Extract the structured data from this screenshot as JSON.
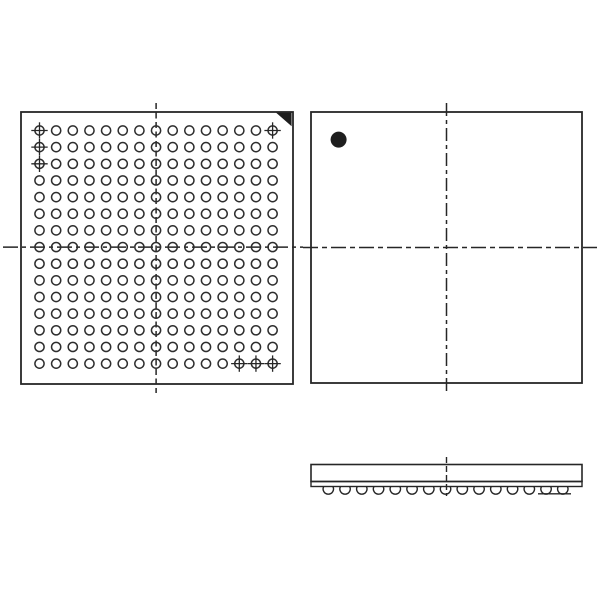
{
  "canvas": {
    "width": 600,
    "height": 600,
    "background": "#ffffff"
  },
  "colors": {
    "line": "#262626",
    "marker_fill": "#1e1e1e",
    "ball_stroke": "#2e2e2e"
  },
  "figure": {
    "kind": "ic-package-outline-drawing",
    "views": [
      "bottom-view-ball-grid",
      "top-view",
      "side-view"
    ]
  },
  "bottom_view": {
    "outline": {
      "x": 21,
      "y": 112,
      "width": 272,
      "height": 272,
      "stroke_width": 1.8
    },
    "ball_grid": {
      "rows": 15,
      "cols": 15,
      "total_balls": 225,
      "x0": 39.5,
      "y0": 130.5,
      "pitch": 16.65,
      "ball_radius": 4.6,
      "ball_stroke_width": 1.5
    },
    "marked_balls": [
      [
        1,
        1
      ],
      [
        2,
        1
      ],
      [
        3,
        1
      ],
      [
        1,
        15
      ],
      [
        15,
        13
      ],
      [
        15,
        14
      ],
      [
        15,
        15
      ]
    ],
    "marked_ball_arm_halflength": 8.2,
    "pin1_triangle_points": "276,112.6 291.6,112.6 291.6,126.2",
    "v_centerline": {
      "x": 156.1,
      "y1": 103,
      "y2": 393,
      "dash": "6 3.5"
    },
    "h_centerline": {
      "y": 247.1,
      "x1": 3,
      "x2": 303,
      "dash": "15 4 4 4"
    }
  },
  "top_view": {
    "outline": {
      "x": 311,
      "y": 112,
      "width": 271,
      "height": 271,
      "stroke_width": 1.8
    },
    "pin1_dot": {
      "cx": 338.6,
      "cy": 139.6,
      "r": 8
    },
    "v_centerline": {
      "x": 446.5,
      "y1": 103,
      "y2": 394,
      "dash": "13 4 4 4"
    },
    "h_centerline": {
      "y": 247.5,
      "x1": 303,
      "x2": 597,
      "dash": "15 4 5 4"
    }
  },
  "side_view": {
    "body": {
      "x": 311,
      "y": 464.5,
      "width": 271,
      "height": 17,
      "stroke_width": 1.6
    },
    "substrate": {
      "x": 311,
      "y": 481.5,
      "width": 271,
      "height": 5,
      "stroke_width": 1.4
    },
    "balls": {
      "count": 15,
      "x0": 328.3,
      "pitch": 16.75,
      "radius": 5.2,
      "top_y": 486.5,
      "stroke_width": 1.4
    },
    "seating_line": {
      "x1": 538,
      "x2": 571,
      "y": 493.8,
      "stroke_width": 1.4
    },
    "v_centerline": {
      "x": 446.5,
      "y1": 457,
      "y2": 496,
      "dash": "6 3"
    }
  }
}
